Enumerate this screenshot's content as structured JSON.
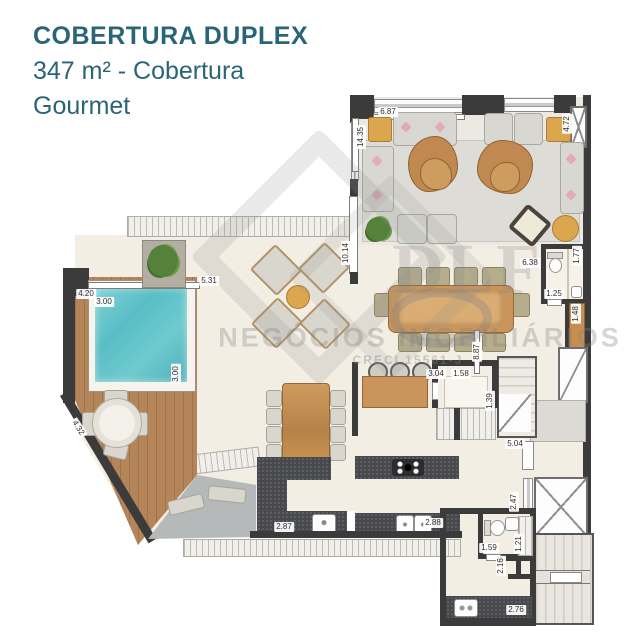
{
  "header": {
    "title": "COBERTURA DUPLEX",
    "subtitle": "347 m² - Cobertura",
    "subtitle2": "Gourmet"
  },
  "watermark": {
    "brand": "DLF",
    "agency": "NEGÓCIOS IMOBILIÁRIOS",
    "creci": "CRECI 15561-J"
  },
  "colors": {
    "accent_teal": "#2a6477",
    "wall_dark": "#3b3b3b",
    "floor_cream": "#f3eee4",
    "deck_wood": "#b5855a",
    "pool_water": "#58bec5",
    "counter_dark": "#47494c",
    "furniture_wood": "#c9955c",
    "accent_ochre": "#dca64e"
  },
  "measurements": [
    {
      "label": "6.87",
      "x": 388,
      "y": 112,
      "rot": 0
    },
    {
      "label": "14.35",
      "x": 361,
      "y": 137,
      "rot": -90
    },
    {
      "label": "4.72",
      "x": 567,
      "y": 124,
      "rot": -90
    },
    {
      "label": "10.14",
      "x": 346,
      "y": 253,
      "rot": -90
    },
    {
      "label": "5.31",
      "x": 209,
      "y": 281,
      "rot": 0
    },
    {
      "label": "4.20",
      "x": 86,
      "y": 294,
      "rot": 0
    },
    {
      "label": "3.00",
      "x": 104,
      "y": 302,
      "rot": 0
    },
    {
      "label": "3.00",
      "x": 176,
      "y": 374,
      "rot": -90
    },
    {
      "label": "4.32",
      "x": 78,
      "y": 428,
      "rot": 57
    },
    {
      "label": "6.38",
      "x": 530,
      "y": 263,
      "rot": 0
    },
    {
      "label": "1.77",
      "x": 577,
      "y": 256,
      "rot": -90
    },
    {
      "label": "1.25",
      "x": 554,
      "y": 294,
      "rot": 0
    },
    {
      "label": "1.48",
      "x": 576,
      "y": 314,
      "rot": -90
    },
    {
      "label": "8.87",
      "x": 477,
      "y": 352,
      "rot": -90
    },
    {
      "label": "3.04",
      "x": 436,
      "y": 374,
      "rot": 0
    },
    {
      "label": "1.58",
      "x": 461,
      "y": 374,
      "rot": 0
    },
    {
      "label": "1.39",
      "x": 490,
      "y": 401,
      "rot": -90
    },
    {
      "label": "5.04",
      "x": 515,
      "y": 444,
      "rot": 0
    },
    {
      "label": "2.47",
      "x": 514,
      "y": 502,
      "rot": -90
    },
    {
      "label": "2.87",
      "x": 284,
      "y": 527,
      "rot": 0
    },
    {
      "label": "2.88",
      "x": 433,
      "y": 523,
      "rot": 0
    },
    {
      "label": "1.59",
      "x": 489,
      "y": 548,
      "rot": 0
    },
    {
      "label": "1.21",
      "x": 519,
      "y": 544,
      "rot": -90
    },
    {
      "label": "2.16",
      "x": 501,
      "y": 566,
      "rot": -90
    },
    {
      "label": "2.76",
      "x": 516,
      "y": 610,
      "rot": 0
    }
  ]
}
